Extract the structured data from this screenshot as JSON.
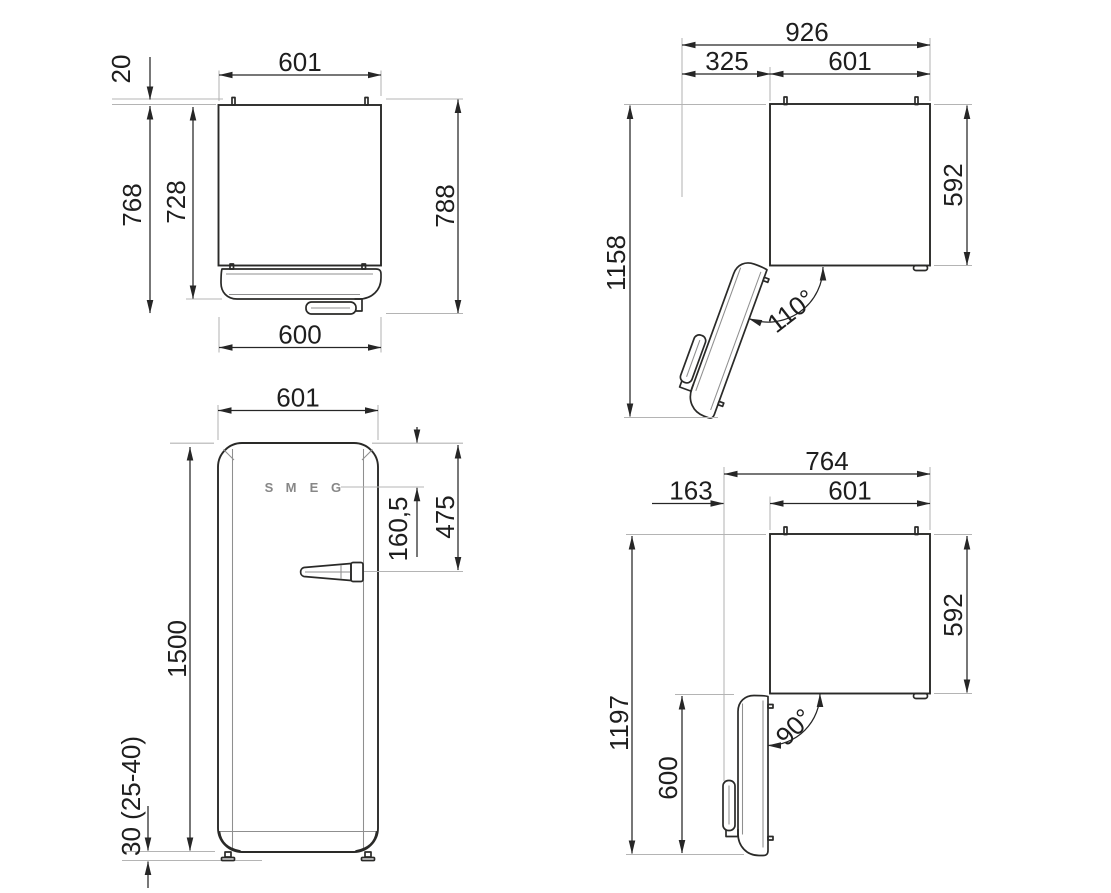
{
  "drawing": {
    "colors": {
      "line": "#2a2a28",
      "extension": "#b4b4b4",
      "detail": "#8f8f8f",
      "text": "#1e1e1e",
      "background": "#ffffff"
    },
    "views": {
      "top_closed": {
        "label": "top-view-door-closed",
        "dims": {
          "width_top": "601",
          "hinge_protrusion": "20",
          "depth_no_hinge": "768",
          "depth_cabinet": "728",
          "depth_total": "788",
          "door_width": "600"
        }
      },
      "top_open_110": {
        "label": "top-view-door-open-110",
        "dims": {
          "overall_width": "926",
          "door_clearance": "325",
          "cabinet_width": "601",
          "overall_depth": "1158",
          "cabinet_depth": "592",
          "opening_angle": "110°"
        }
      },
      "front": {
        "label": "front-view",
        "dims": {
          "width": "601",
          "handle_from_top": "475",
          "logo_from_top": "160,5",
          "height": "1500",
          "feet_height": "30 (25-40)"
        },
        "logo_letters": [
          "S",
          "M",
          "E",
          "G"
        ]
      },
      "top_open_90": {
        "label": "top-view-door-open-90",
        "dims": {
          "overall_width": "764",
          "door_clearance": "163",
          "cabinet_width": "601",
          "overall_depth": "1197",
          "door_width": "600",
          "cabinet_depth": "592",
          "opening_angle": "90°"
        }
      }
    }
  }
}
